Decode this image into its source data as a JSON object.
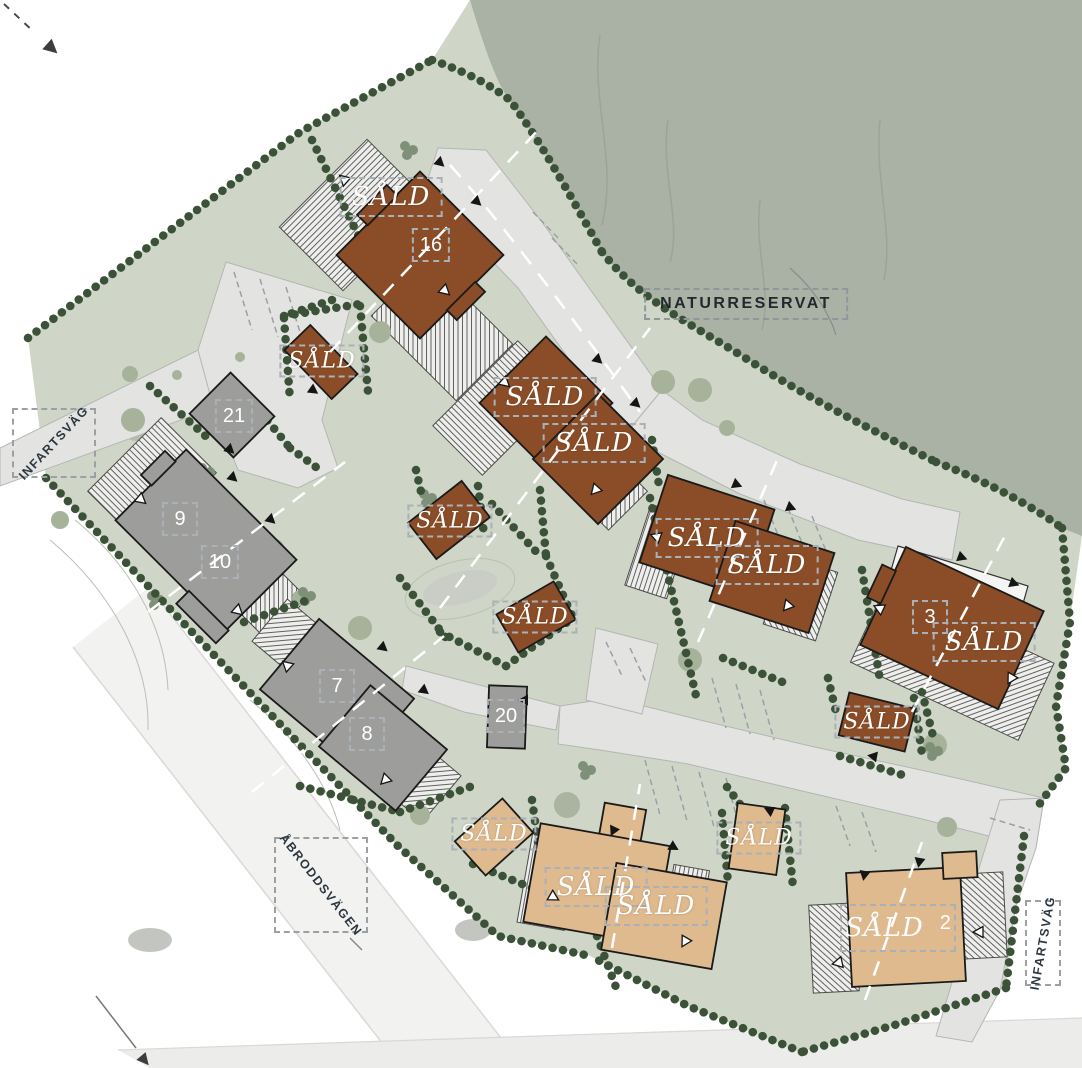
{
  "region_labels": {
    "nature_reserve": "NATURRESERVAT"
  },
  "street_labels": {
    "entry_west": "INFARTSVÄG",
    "main_street": "ÅBRODDSVÄGEN",
    "entry_east": "INFARTSVÄG"
  },
  "plots": [
    {
      "number": "16",
      "status": "SÅLD"
    },
    {
      "status": "SÅLD"
    },
    {
      "number": "21"
    },
    {
      "number": "9"
    },
    {
      "number": "10"
    },
    {
      "status": "SÅLD"
    },
    {
      "status": "SÅLD"
    },
    {
      "status": "SÅLD"
    },
    {
      "status": "SÅLD"
    },
    {
      "status": "SÅLD"
    },
    {
      "status": "SÅLD"
    },
    {
      "number": "3",
      "status": "SÅLD"
    },
    {
      "status": "SÅLD"
    },
    {
      "number": "7"
    },
    {
      "number": "8"
    },
    {
      "number": "20"
    },
    {
      "status": "SÅLD"
    },
    {
      "status": "SÅLD"
    },
    {
      "status": "SÅLD"
    },
    {
      "status": "SÅLD"
    },
    {
      "number": "2",
      "status": "SÅLD"
    }
  ],
  "colors": {
    "sold_house_brown": "#8a4d27",
    "sold_house_beige": "#dfba8e",
    "available_house_grey": "#9d9d9b",
    "parcel_green": "#cfd6c8",
    "nature_reserve_green": "#a9b2a5",
    "hedge_green": "#3b5238",
    "road_grey": "#e3e3e1"
  }
}
